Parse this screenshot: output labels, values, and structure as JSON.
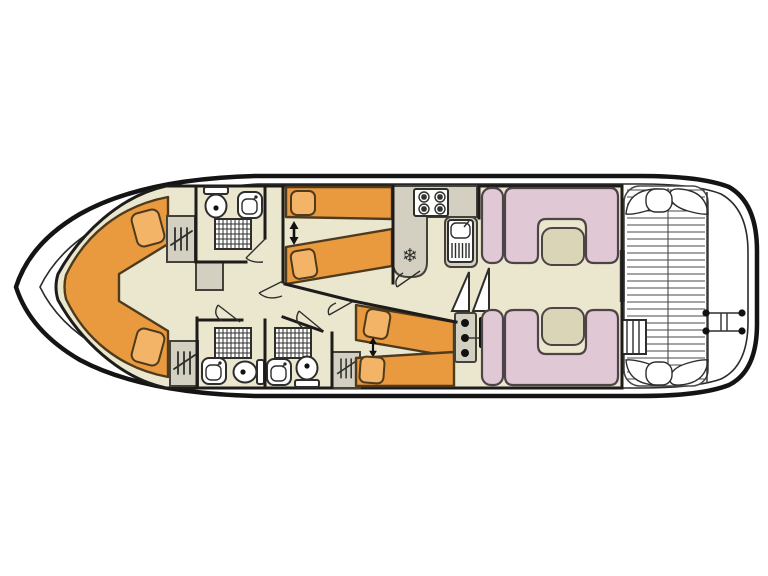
{
  "title": "Houseboat interior deck plan",
  "colors": {
    "bg": "#ffffff",
    "hull": "#141414",
    "innerline": "#2b2b2b",
    "floor": "#ebe7cf",
    "wall": "#1d1c1a",
    "furn": "#d3d0c1",
    "furnline": "#44413a",
    "bed": "#e9993e",
    "pillow": "#f3b468",
    "bedline": "#4e3a1c",
    "seat": "#e1c8d5",
    "seatline": "#4c4447",
    "table": "#d9d5b6",
    "white": "#ffffff",
    "line": "#2e2e2c",
    "slat": "#4a4a48",
    "dot": "#111111"
  },
  "icons": {
    "fridge_snowflake": "❄"
  },
  "plan": {
    "vessel": "motor-cruiser floor plan, bow left / stern right",
    "areas": [
      {
        "name": "bow-cabin",
        "features": [
          "v-shaped-double-berth",
          "two-pillows",
          "wardrobe"
        ]
      },
      {
        "name": "forward-bathroom",
        "features": [
          "toilet",
          "washbasin",
          "shower"
        ]
      },
      {
        "name": "forward-twin-cabin",
        "features": [
          "two-single-beds",
          "join-arrow",
          "wardrobe"
        ]
      },
      {
        "name": "midship-bathroom-port",
        "features": [
          "toilet",
          "washbasin",
          "shower"
        ]
      },
      {
        "name": "midship-bathroom-starboard",
        "features": [
          "toilet",
          "washbasin",
          "shower",
          "wardrobe"
        ]
      },
      {
        "name": "aft-twin-cabin",
        "features": [
          "two-single-beds",
          "join-arrow",
          "wardrobe"
        ]
      },
      {
        "name": "galley",
        "features": [
          "four-burner-stove",
          "sink-with-drainer",
          "fridge"
        ]
      },
      {
        "name": "helm-station",
        "features": [
          "console-three-instruments",
          "steering-bar",
          "companionway-stairs"
        ]
      },
      {
        "name": "saloon",
        "features": [
          "two-u-shaped-dinette-benches",
          "two-tables",
          "two-side-seats"
        ]
      },
      {
        "name": "aft-deck",
        "features": [
          "slatted-floor",
          "corner-seats",
          "boarding-steps"
        ]
      },
      {
        "name": "swim-platform",
        "features": [
          "boarding-ladder"
        ]
      }
    ]
  }
}
